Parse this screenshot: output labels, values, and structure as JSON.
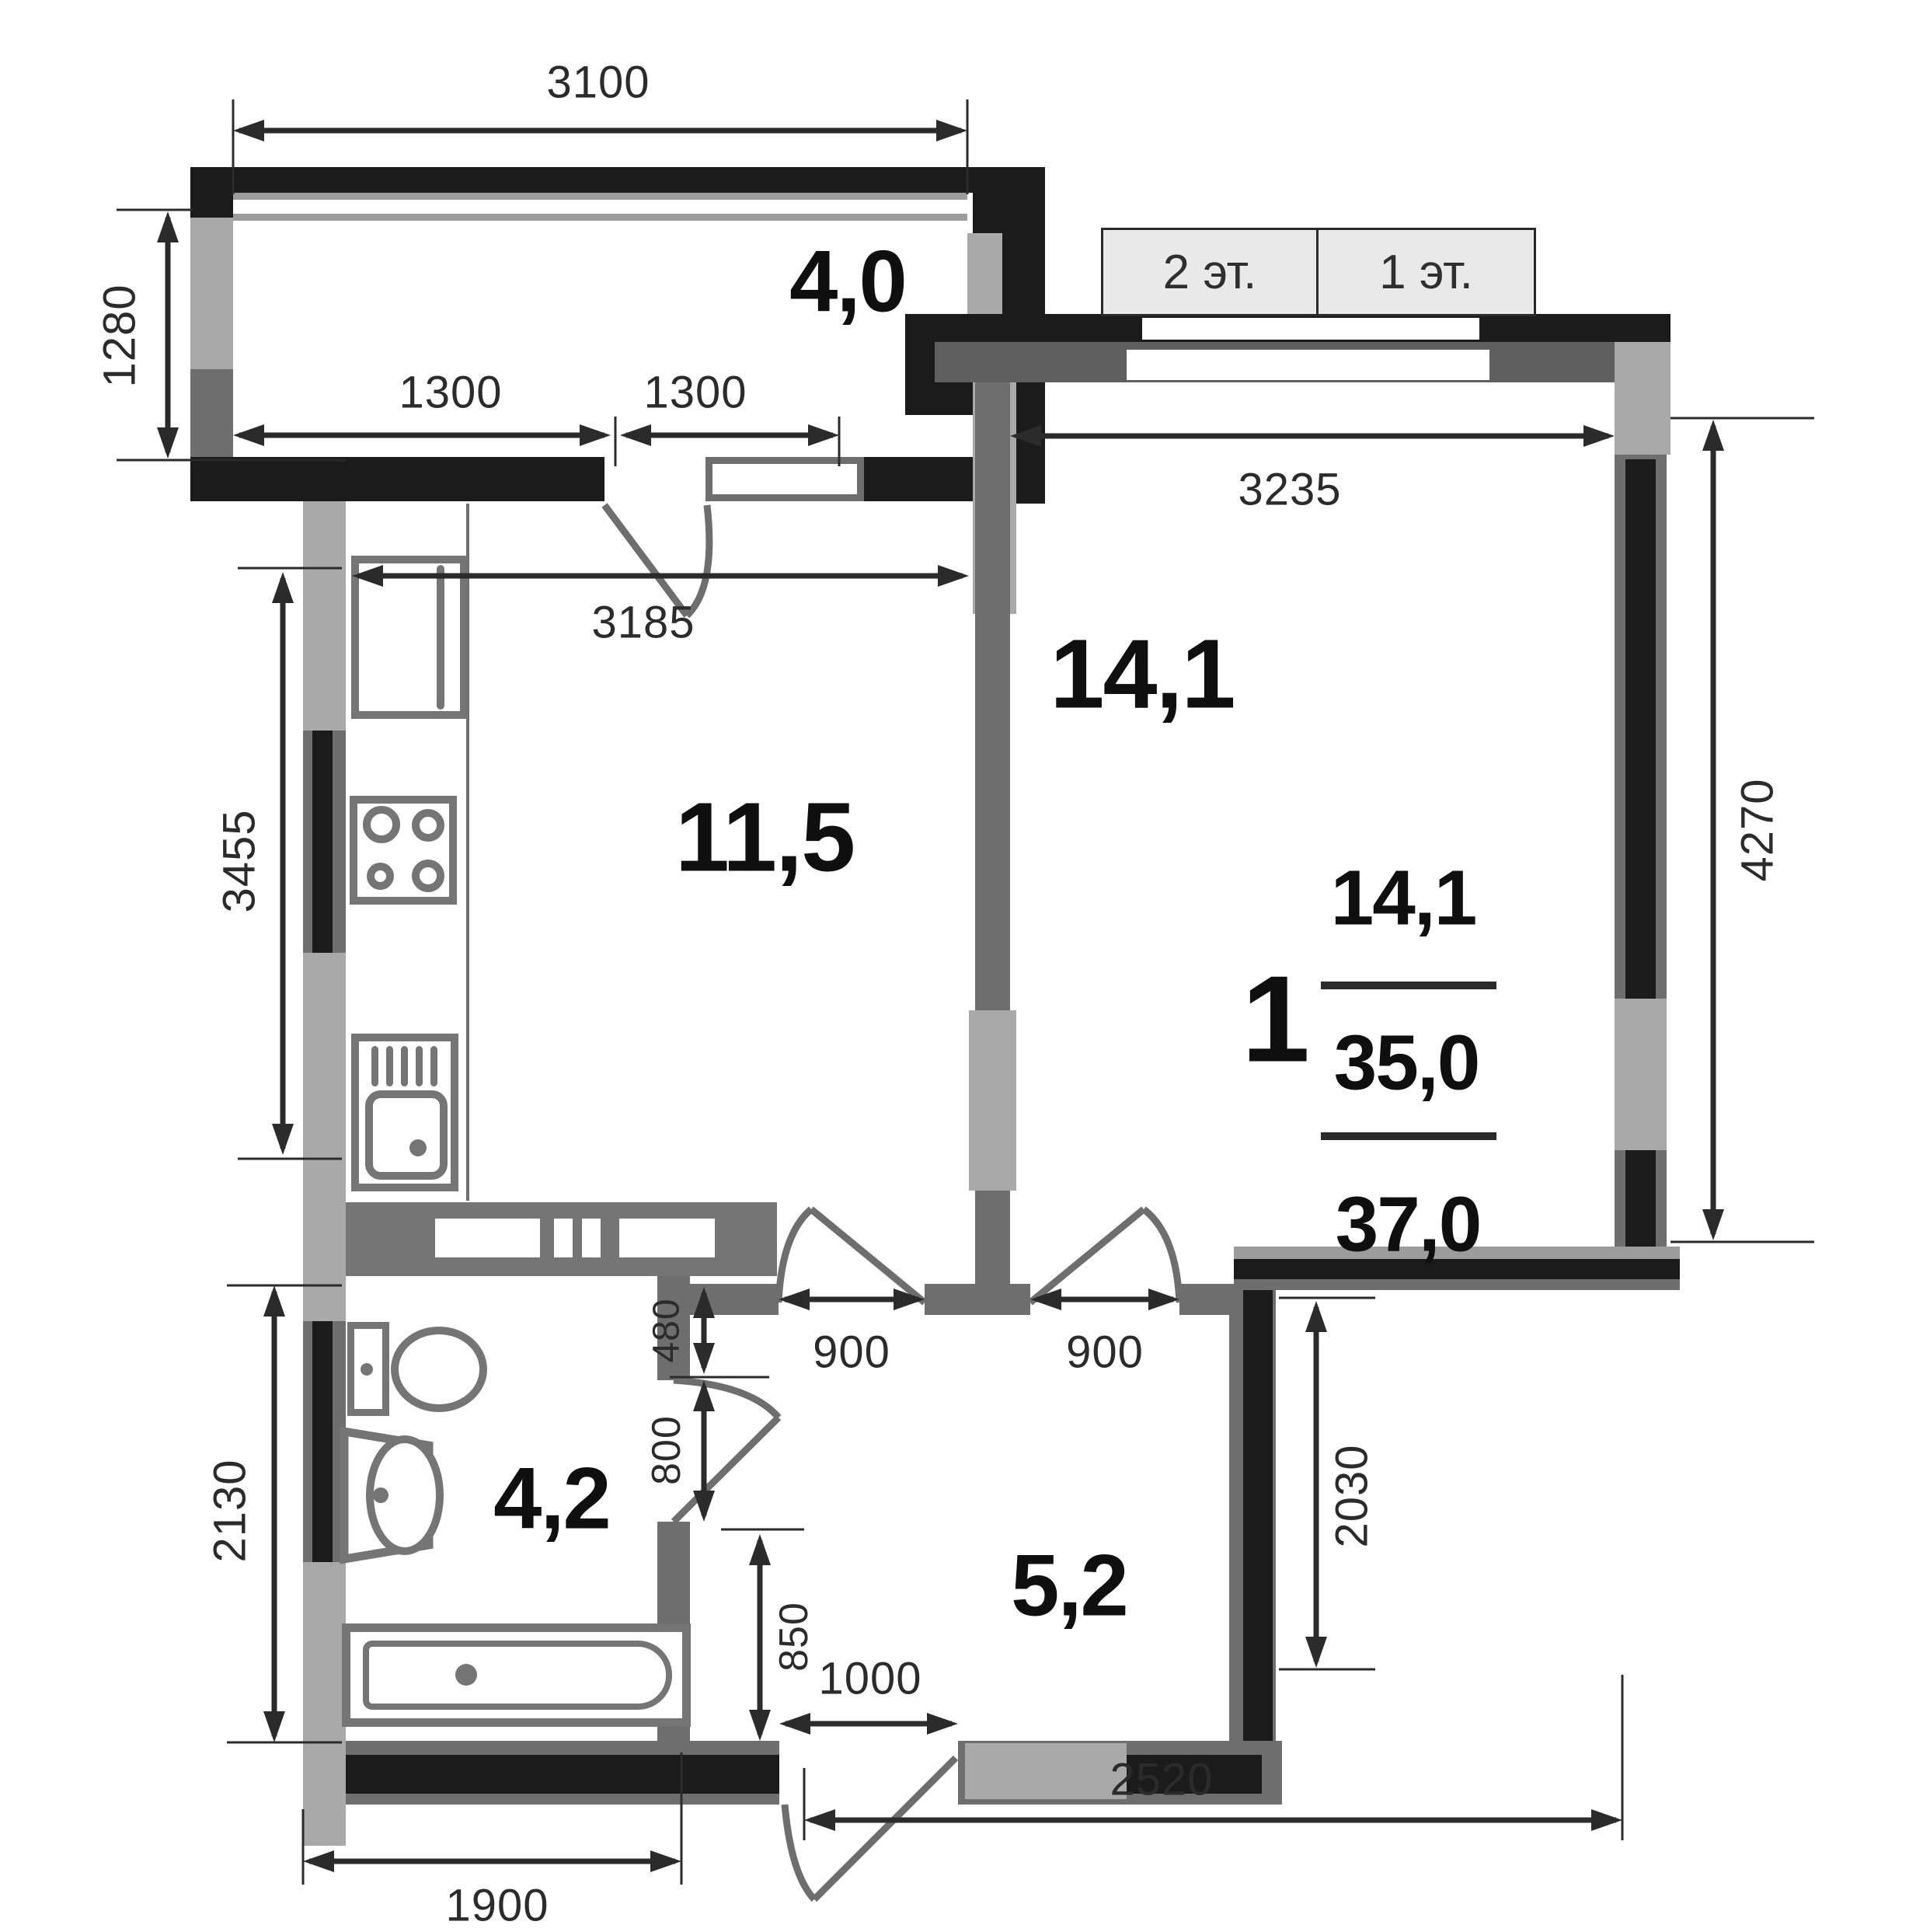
{
  "plan": {
    "floor_buttons": {
      "floor2": "2 эт.",
      "floor1": "1 эт."
    },
    "rooms": {
      "balcony": "4,0",
      "kitchen": "11,5",
      "living": "14,1",
      "bathroom": "4,2",
      "hallway": "5,2"
    },
    "summary": {
      "rooms_count": "1",
      "living_area": "14,1",
      "area_without_balcony": "35,0",
      "total_area": "37,0"
    },
    "dims": {
      "balcony_width": "3100",
      "balcony_depth": "1280",
      "balcony_glass_left": "1300",
      "balcony_glass_right": "1300",
      "kitchen_width": "3185",
      "kitchen_depth": "3455",
      "living_width": "3235",
      "living_depth": "4270",
      "bathroom_depth": "2130",
      "bathroom_width": "1900",
      "kitchen_door": "900",
      "living_door": "900",
      "wall_seg_480": "480",
      "bathroom_door": "800",
      "wall_seg_850": "850",
      "entrance_door": "1000",
      "hall_side": "2030",
      "hall_bottom_width": "2520"
    },
    "colors": {
      "wall_black": "#1b1b1b",
      "wall_gray": "#6e6e6e",
      "pier_gray": "#a9a9a9",
      "fixture_gray": "#757575",
      "dim_color": "#2b2b2b",
      "button_bg": "#e9e9e9"
    }
  }
}
